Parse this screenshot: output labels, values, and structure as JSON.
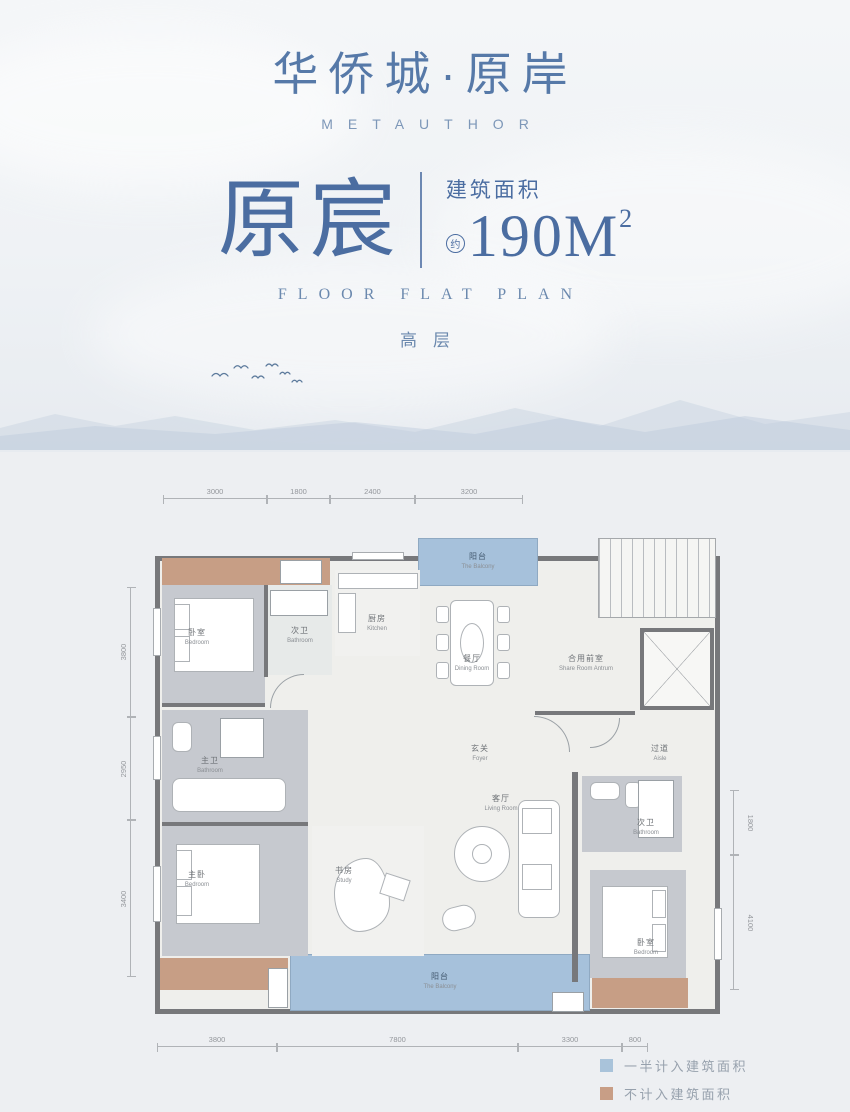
{
  "brand": {
    "logo_cn": "华侨城·原岸",
    "logo_en": "METAUTHOR"
  },
  "hero": {
    "unit_name": "原宸",
    "area_label": "建筑面积",
    "approx": "约",
    "area_value": "190M",
    "area_sup": "2",
    "plan_en": "FLOOR FLAT PLAN",
    "floor_type": "高层"
  },
  "plan": {
    "dims_top": [
      "3000",
      "1800",
      "2400",
      "3200"
    ],
    "dims_bottom": [
      "3800",
      "7800",
      "3300",
      "800"
    ],
    "dims_left": [
      "3800",
      "2950",
      "3400"
    ],
    "dims_right": [
      "1800",
      "4100"
    ],
    "rooms": [
      {
        "id": "balcony-top",
        "cn": "阳台",
        "en": "The Balcony"
      },
      {
        "id": "bedroom-top-left",
        "cn": "卧室",
        "en": "Bedroom"
      },
      {
        "id": "bathroom-top",
        "cn": "次卫",
        "en": "Bathroom"
      },
      {
        "id": "kitchen",
        "cn": "厨房",
        "en": "Kitchen"
      },
      {
        "id": "dining-room",
        "cn": "餐厅",
        "en": "Dining Room"
      },
      {
        "id": "share-room",
        "cn": "合用前室",
        "en": "Share Room Antrum"
      },
      {
        "id": "foyer",
        "cn": "玄关",
        "en": "Foyer"
      },
      {
        "id": "aisle",
        "cn": "过道",
        "en": "Aisle"
      },
      {
        "id": "master-bathroom",
        "cn": "主卫",
        "en": "Bathroom"
      },
      {
        "id": "master-bedroom",
        "cn": "主卧",
        "en": "Bedroom"
      },
      {
        "id": "study",
        "cn": "书房",
        "en": "Study"
      },
      {
        "id": "living-room",
        "cn": "客厅",
        "en": "Living Room"
      },
      {
        "id": "bathroom-bottom-right",
        "cn": "次卫",
        "en": "Bathroom"
      },
      {
        "id": "bedroom-bottom-right",
        "cn": "卧室",
        "en": "Bedroom"
      },
      {
        "id": "balcony-bottom",
        "cn": "阳台",
        "en": "The Balcony"
      }
    ]
  },
  "legend": {
    "items": [
      {
        "label": "一半计入建筑面积",
        "color": "#a9c3da"
      },
      {
        "label": "不计入建筑面积",
        "color": "#c89e86"
      }
    ]
  },
  "colors": {
    "accent_blue": "#4b6da1",
    "logo_blue": "#5679a8",
    "wall_gray": "#77787b",
    "room_gray": "#c6c9cf",
    "balcony_blue": "#a6c1db",
    "uncounted_tan": "#c79e85"
  }
}
